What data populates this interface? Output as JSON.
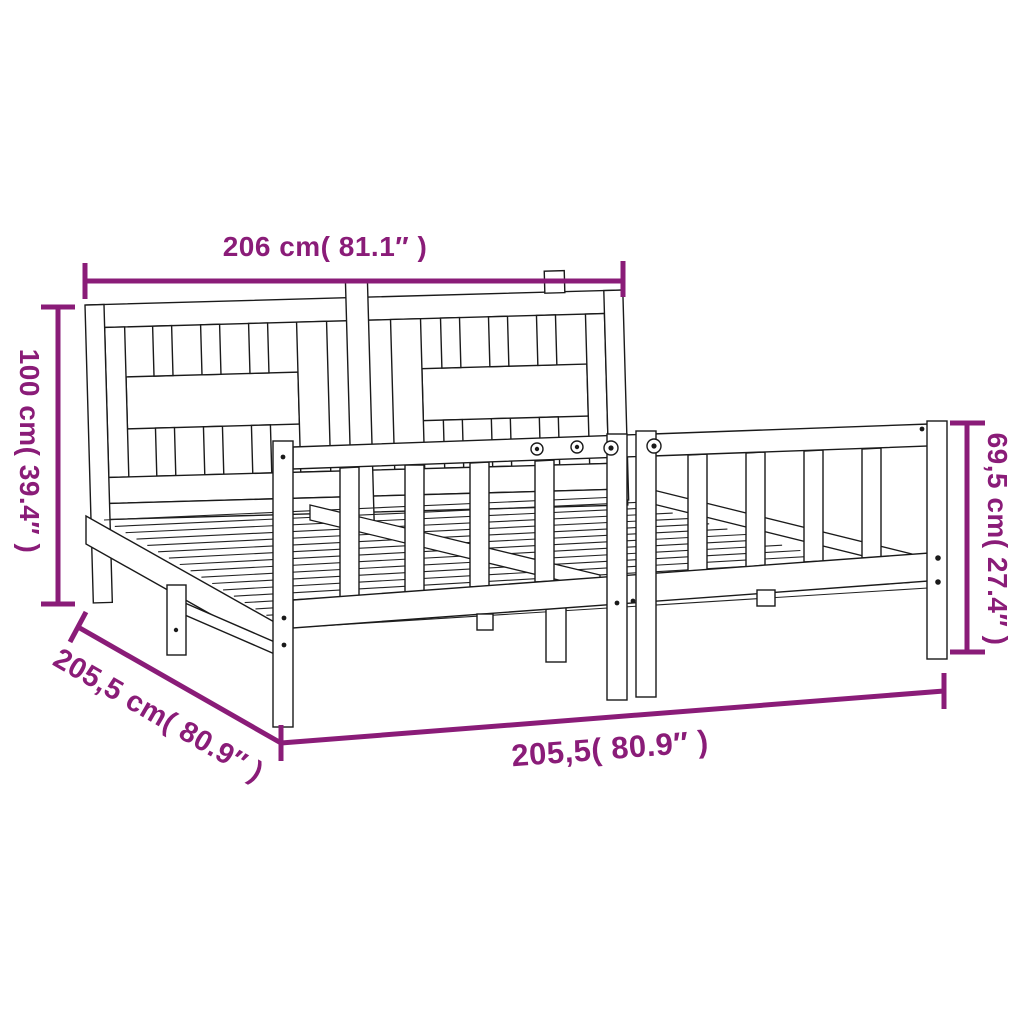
{
  "diagram": {
    "subject": "bed-frame-with-headboard",
    "annotation_color": "#8A1C78",
    "line_color": "#1a1a1a",
    "background": "#ffffff",
    "dimensions": {
      "width": {
        "label": "206 cm( 81.1″ )",
        "cm": 206,
        "inches": 81.1,
        "orientation": "horizontal-top"
      },
      "headboard_height": {
        "label": "100 cm( 39.4″ )",
        "cm": 100,
        "inches": 39.4,
        "orientation": "vertical-left"
      },
      "footboard_height": {
        "label": "69,5 cm( 27.4″ )",
        "cm": 69.5,
        "inches": 27.4,
        "orientation": "vertical-right"
      },
      "depth": {
        "label": "205,5 cm( 80.9″ )",
        "cm": 205.5,
        "inches": 80.9,
        "orientation": "diagonal-bottom-left"
      },
      "length": {
        "label": "205,5( 80.9″ )",
        "cm": 205.5,
        "inches": 80.9,
        "orientation": "horizontal-bottom"
      }
    }
  }
}
